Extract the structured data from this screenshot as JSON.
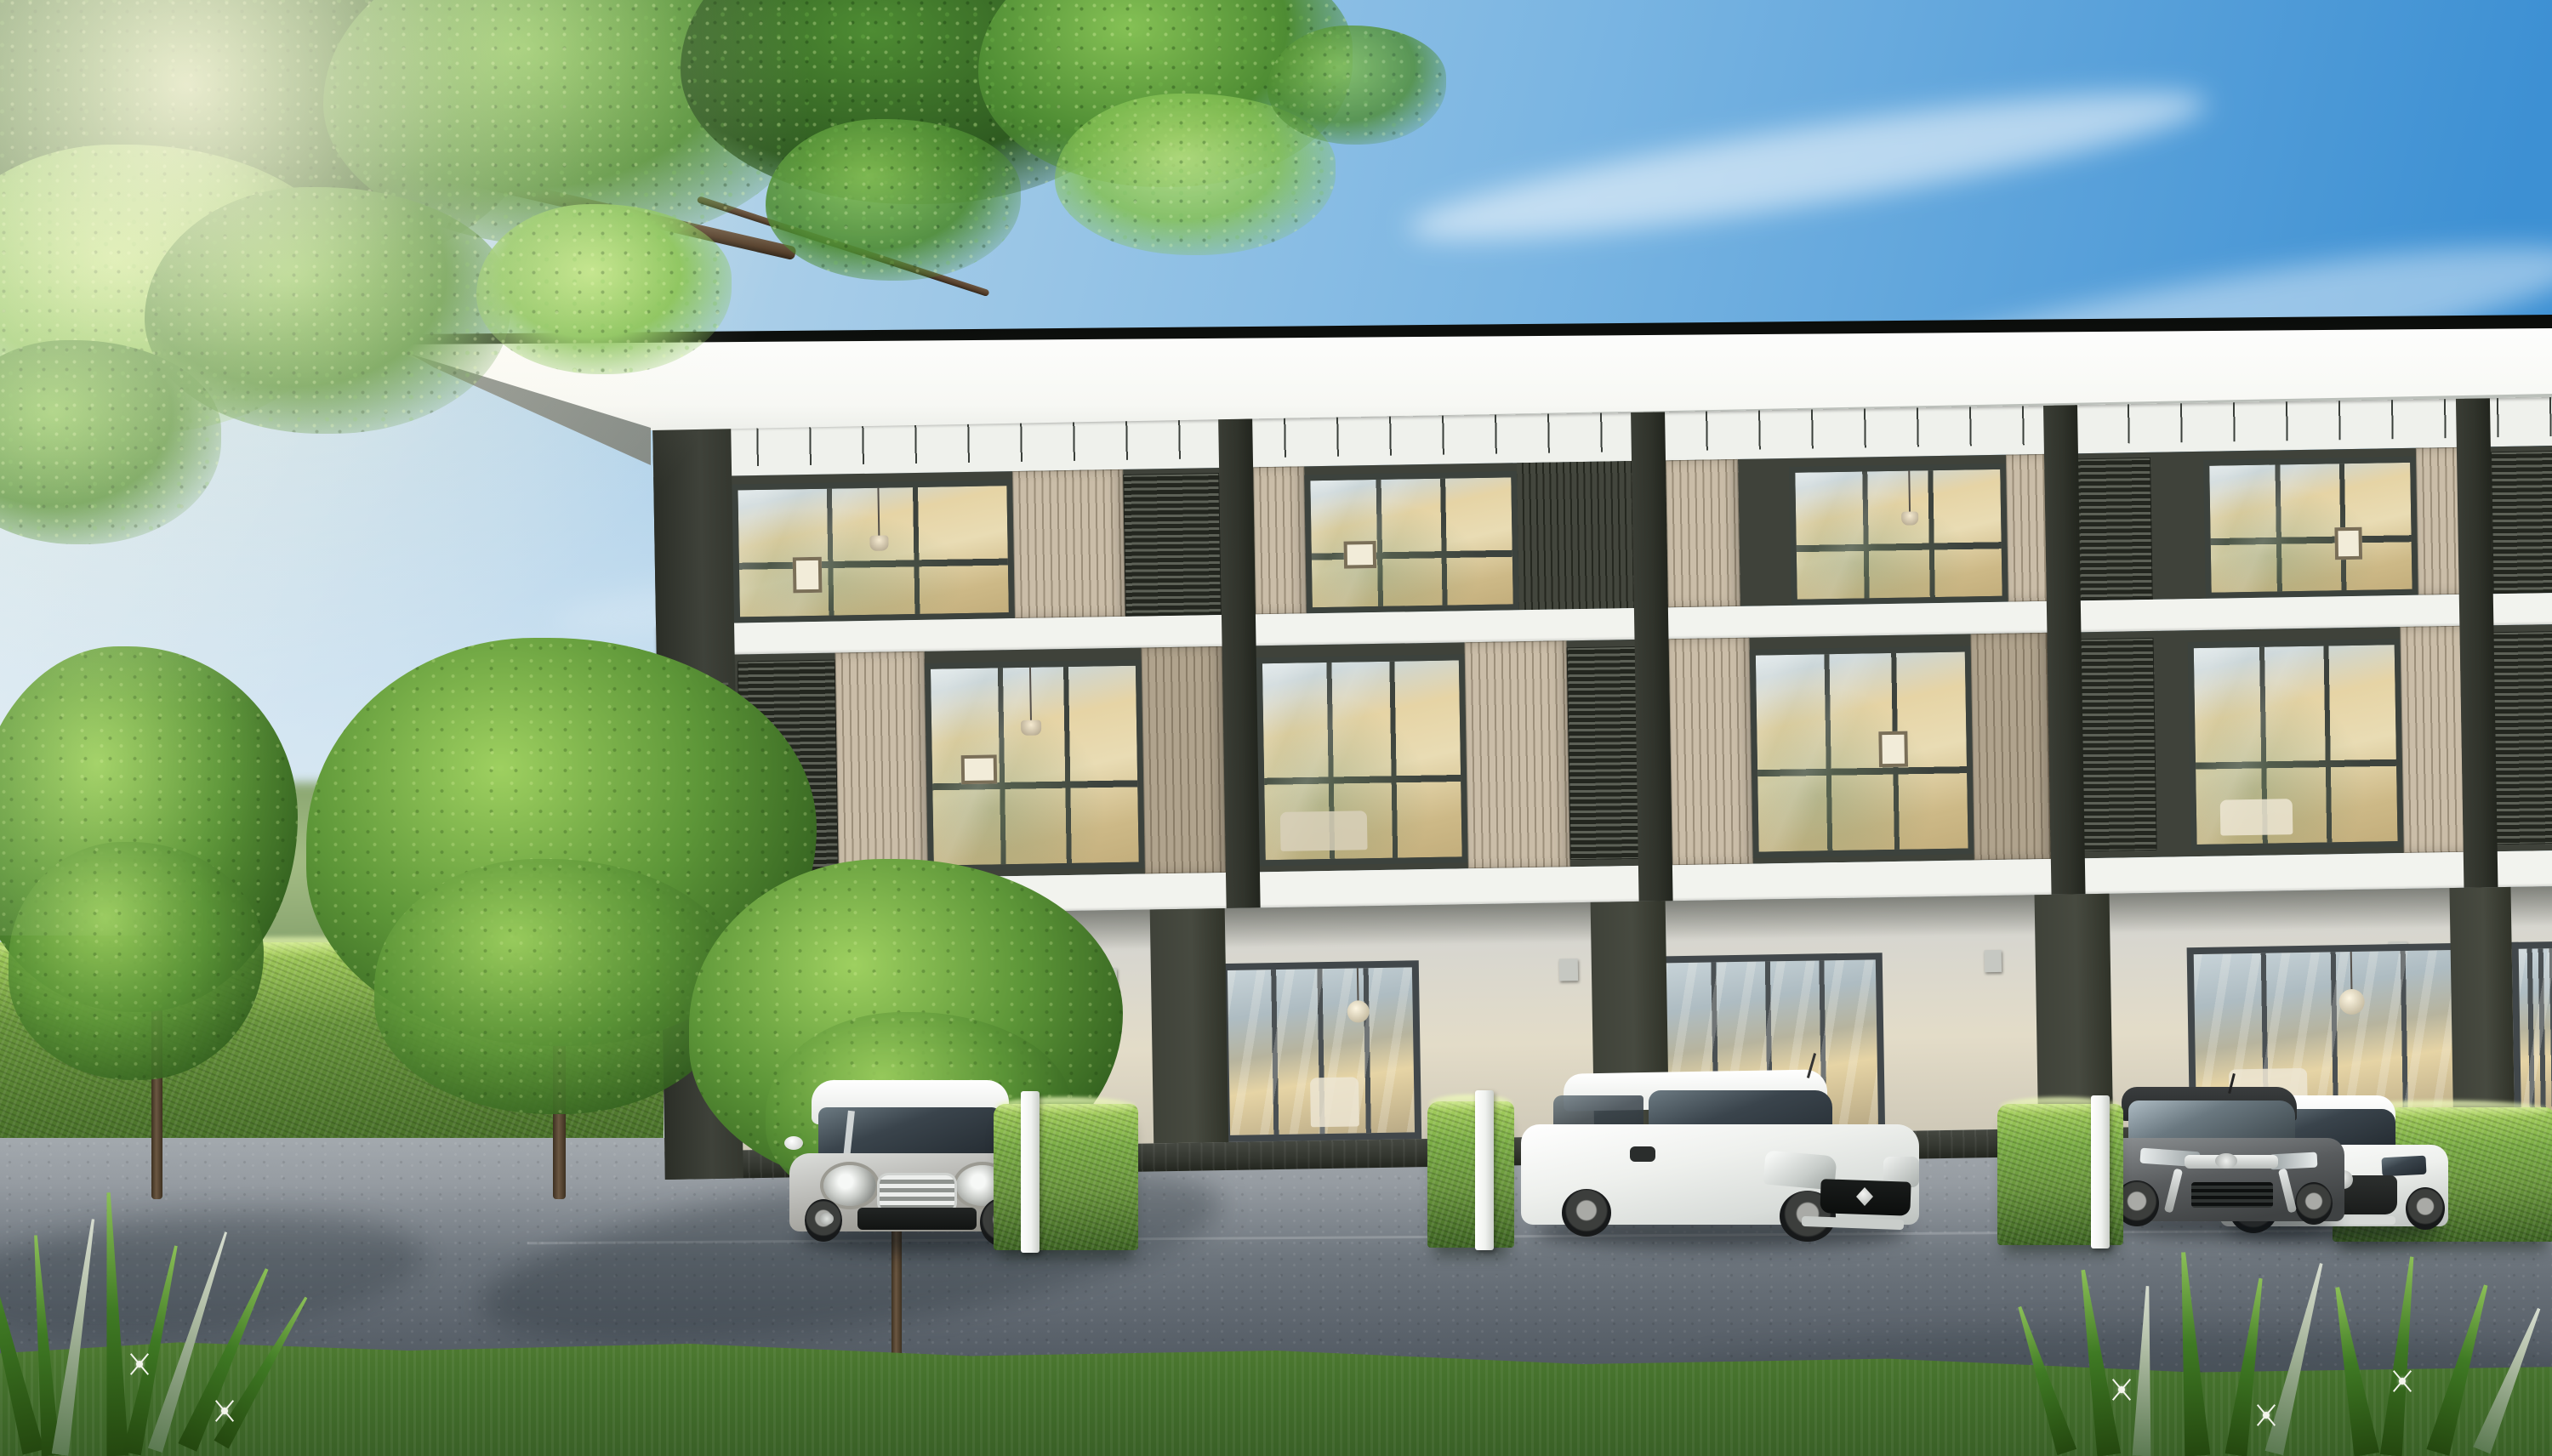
{
  "meta": {
    "title": "3D architectural rendering — modern three-storey townhouse row at dusk-lit afternoon",
    "no_visible_text": true
  },
  "scene": {
    "sky": {
      "label": "clear blue sky with wispy cirrus clouds, hazier toward upper-left sun"
    },
    "canopy": {
      "label": "overhanging tree canopy with dark branches",
      "position": "top-left"
    },
    "building": {
      "label": "modern 3-storey townhouse row",
      "storeys": 3,
      "visible_unit_bays": 5,
      "roof": "white flat roof slab with deep overhang and dark edge trim",
      "materials": [
        "white concrete slab bands",
        "beige vertical timber slat screens",
        "dark metal horizontal louvers",
        "floor-to-ceiling warm-lit glazing",
        "grey ground-floor walls with glass sliders",
        "dark brick plinth"
      ]
    },
    "cars": [
      {
        "label": "silver Mini Cooper hatchback with white roof",
        "body_color": "#b9b9b5",
        "position": "unit 1 parking pad"
      },
      {
        "label": "white Suzuki Swift hatchback",
        "body_color": "#eef0ed",
        "position": "unit 3 parking pad"
      },
      {
        "label": "dark grey Toyota hatchback",
        "body_color": "#595c5e",
        "position": "unit 4 parking pad"
      },
      {
        "label": "white Mazda hatchback",
        "body_color": "#edeeec",
        "position": "unit 4 parking pad, right"
      }
    ],
    "vegetation": {
      "trees_on_lawn": 3,
      "parking_divider_hedges": 4,
      "hedge_posts": "white square posts at hedge ends",
      "perimeter_hedge": "long clipped hedge along left boundary with background treeline",
      "foreground": "spider-lily shrubs and grass strip with white flowers in both bottom corners",
      "flower_bed": "white ground-cover flower band with dark stone curb on the left lawn"
    },
    "ground": {
      "driveway": "grey asphalt with lighter concrete apron",
      "lawn": "left-side lawn",
      "shadows": "soft tree shadows on pavement"
    }
  },
  "colors": {
    "skyDeep": "#3d90d3",
    "skyMid": "#7ab5e2",
    "skyPale": "#b5d4ea",
    "skyHaze": "#cfe2ee",
    "treelineFar": "#7f9c68",
    "treelineLite": "#a5bd85",
    "hedgeLite": "#a9d25f",
    "hedgeMid": "#69953c",
    "hedgeDark": "#3e6523",
    "lawnLite": "#7cab52",
    "lawnMid": "#639441",
    "grassFront": "#537f33",
    "grassFrontDark": "#395f26",
    "leafBlade": "#3f7a24",
    "leafBladeLite": "#8cc057",
    "flowerWhite": "#f3f4ec",
    "curb": "#454e48",
    "canopyDark": "#2e5a20",
    "canopyMid": "#4e8c33",
    "canopyLite": "#85c155",
    "branch": "#553f2b",
    "roofEdge": "#20241f",
    "fasciaWhite": "#f7f8f4",
    "fasciaShade": "#d9dcd6",
    "soffit": "#aab0ab",
    "bandWhite": "#eff1ec",
    "tick": "#3a3f3a",
    "slabWhite": "#f2f3ee",
    "finDark": "#30332b",
    "flankDark": "#3f423a",
    "louvreLine": "#23261f",
    "slatBeige": "#cabda8",
    "slatBeigeLine": "#9c8f7a",
    "slatBeigeShade": "#b0a38d",
    "darkSlat": "#43463d",
    "winFrame": "#3c423d",
    "glassWarm": "#e6d4a5",
    "glassWarmDeep": "#cdb987",
    "interiorWarm": "#e9dcb4",
    "groundWall": "#d7d6cf",
    "groundWallCream": "#e3dcc8",
    "groundDark": "#474a40",
    "plinth": "#33362f",
    "asphalt": "#6d757d",
    "asphaltDark": "#525a63",
    "apron": "#a3a9ae",
    "carSilver": "#b9b9b5",
    "carWhite": "#eef0ed",
    "carDark": "#595c5e",
    "postWhite": "#f0f2ef",
    "cLite": "#9ed060",
    "cMid": "#5d9638",
    "cDark": "#33611f"
  }
}
